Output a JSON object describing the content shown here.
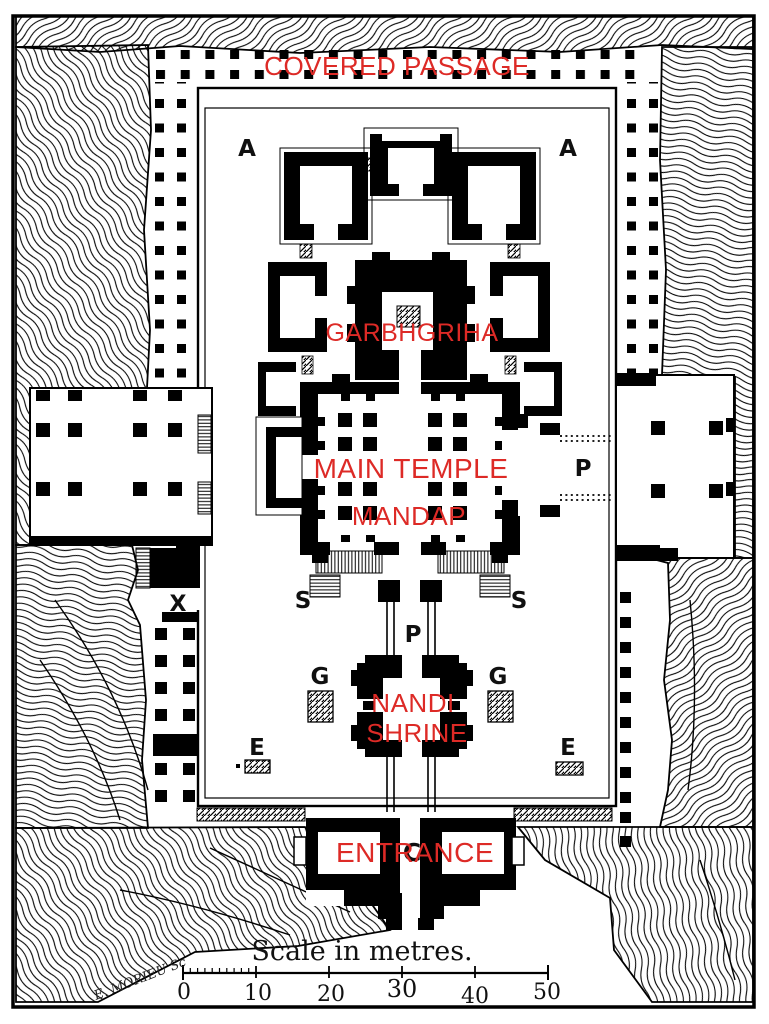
{
  "labels": {
    "covered_passage": "COVERED PASSAGE",
    "garbhgriha": "GARBHGRIHA",
    "main_temple": "MAIN TEMPLE",
    "mandap": "MANDAP",
    "nandi_shrine_line1": "NANDI",
    "nandi_shrine_line2": "SHRINE",
    "entrance": "ENTRANCE"
  },
  "letters": {
    "a_west": "A",
    "a_east": "A",
    "p_bridge_east": "P",
    "p_bridge_south": "P",
    "s_west": "S",
    "s_east": "S",
    "g_west": "G",
    "g_east": "G",
    "e_west": "E",
    "e_east": "E",
    "x": "X",
    "c": "C"
  },
  "scale_bar": {
    "caption": "Scale in metres.",
    "ticks": [
      "0",
      "10",
      "20",
      "30",
      "40",
      "50"
    ]
  },
  "signature": "E. MORIEU Sc",
  "colors": {
    "label_red": "#dd2a26",
    "ink": "#000000",
    "paper": "#ffffff"
  }
}
